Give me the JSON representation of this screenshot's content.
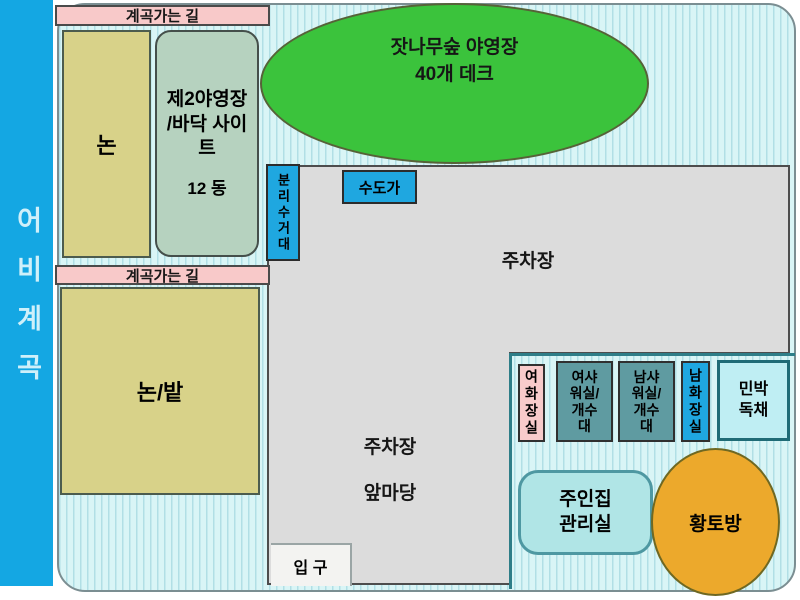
{
  "valley_bar": {
    "label": "어비계곡"
  },
  "roads": {
    "top": "계곡가는 길",
    "middle": "계곡가는 길"
  },
  "zones": {
    "rice_paddy": {
      "label": "논"
    },
    "site2": {
      "name": "제2야영장 /바닥 사이트",
      "units": "12 동"
    },
    "pine_camp": {
      "name": "잣나무숲 야영장",
      "capacity": "40개 데크"
    },
    "recycling": {
      "label": "분리수거대"
    },
    "water_station": {
      "label": "수도가"
    },
    "parking_upper": {
      "label": "주차장"
    },
    "rice_field": {
      "label": "논/밭"
    },
    "parking_lower": {
      "line1": "주차장",
      "line2": "앞마당"
    },
    "entrance": {
      "label": "입 구"
    },
    "owner_house": {
      "line1": "주인집",
      "line2": "관리실"
    },
    "loess_room": {
      "label": "황토방"
    }
  },
  "facilities": [
    {
      "label": "여화장실"
    },
    {
      "label": "여샤워실/개수대"
    },
    {
      "label": "남샤워실/개수대"
    },
    {
      "label": "남화장실"
    },
    {
      "label": "민박독채",
      "line1": "민박",
      "line2": "독채"
    }
  ],
  "colors": {
    "valley_bar_blue": "#14a7e3",
    "map_background": "#d9f5f6",
    "road_pink": "#f8c9c9",
    "field_yellow": "#d8d289",
    "site2_green": "#b6d2bf",
    "camp_green": "#3bc33c",
    "parking_gray": "#dcdcdc",
    "water_blue": "#1fa7e0",
    "shower_teal": "#5f9ba1",
    "toilet_pink": "#f8cbcb",
    "minbak_cyan": "#bfeef3",
    "owner_cyan": "#b0e5e6",
    "loess_orange": "#eca92c"
  }
}
